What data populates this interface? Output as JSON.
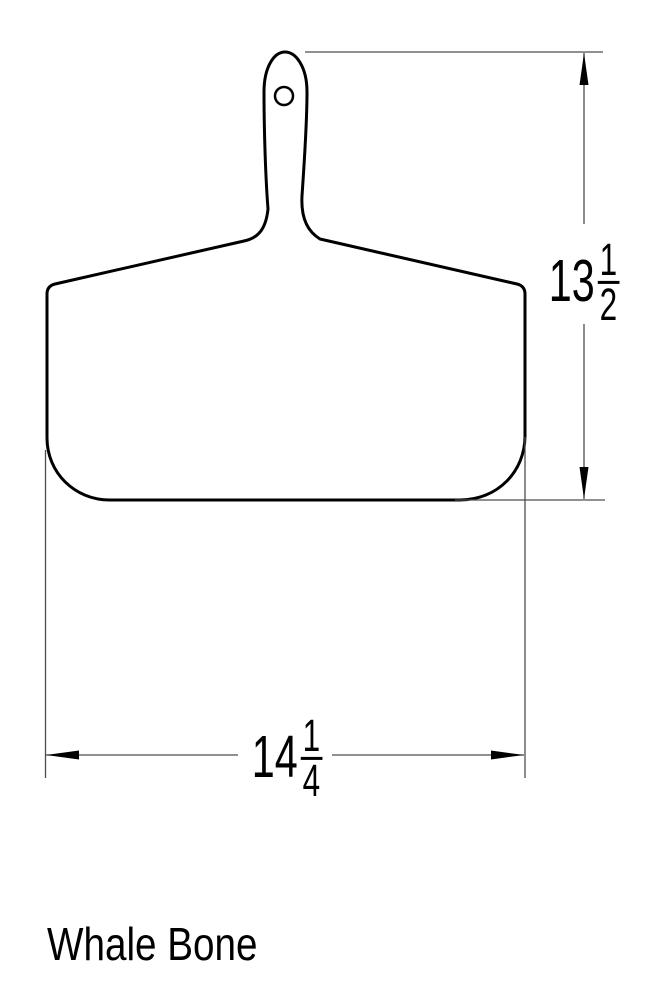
{
  "drawing": {
    "title": "Whale Bone",
    "height_dimension": {
      "whole": "13",
      "numerator": "1",
      "denominator": "2"
    },
    "width_dimension": {
      "whole": "14",
      "numerator": "1",
      "denominator": "4"
    },
    "colors": {
      "outline": "#000000",
      "dimension_line": "#4d4d4d",
      "background": "#ffffff",
      "text": "#000000"
    }
  }
}
